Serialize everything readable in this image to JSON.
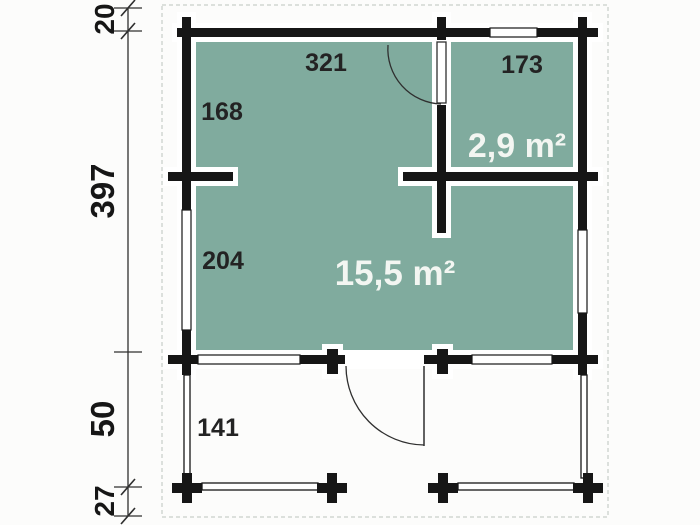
{
  "colors": {
    "background": "#FCFCFB",
    "room_fill": "#80AB9E",
    "wall": "#161616",
    "line": "#2F2F2F",
    "area_text": "#F3F6F2",
    "number_text": "#232323",
    "dim_text": "#161616",
    "dashed_border": "#C8CEC9"
  },
  "labels": {
    "dim_top_offset": "20",
    "dim_house_depth": "397",
    "dim_terrace_depth": "50",
    "dim_terrace_edge": "27",
    "room1_width": "321",
    "room1_wall_left": "168",
    "room2_width": "173",
    "room2_area": "2,9 m²",
    "main_wall_left": "204",
    "main_area": "15,5 m²",
    "terrace_side": "141"
  }
}
